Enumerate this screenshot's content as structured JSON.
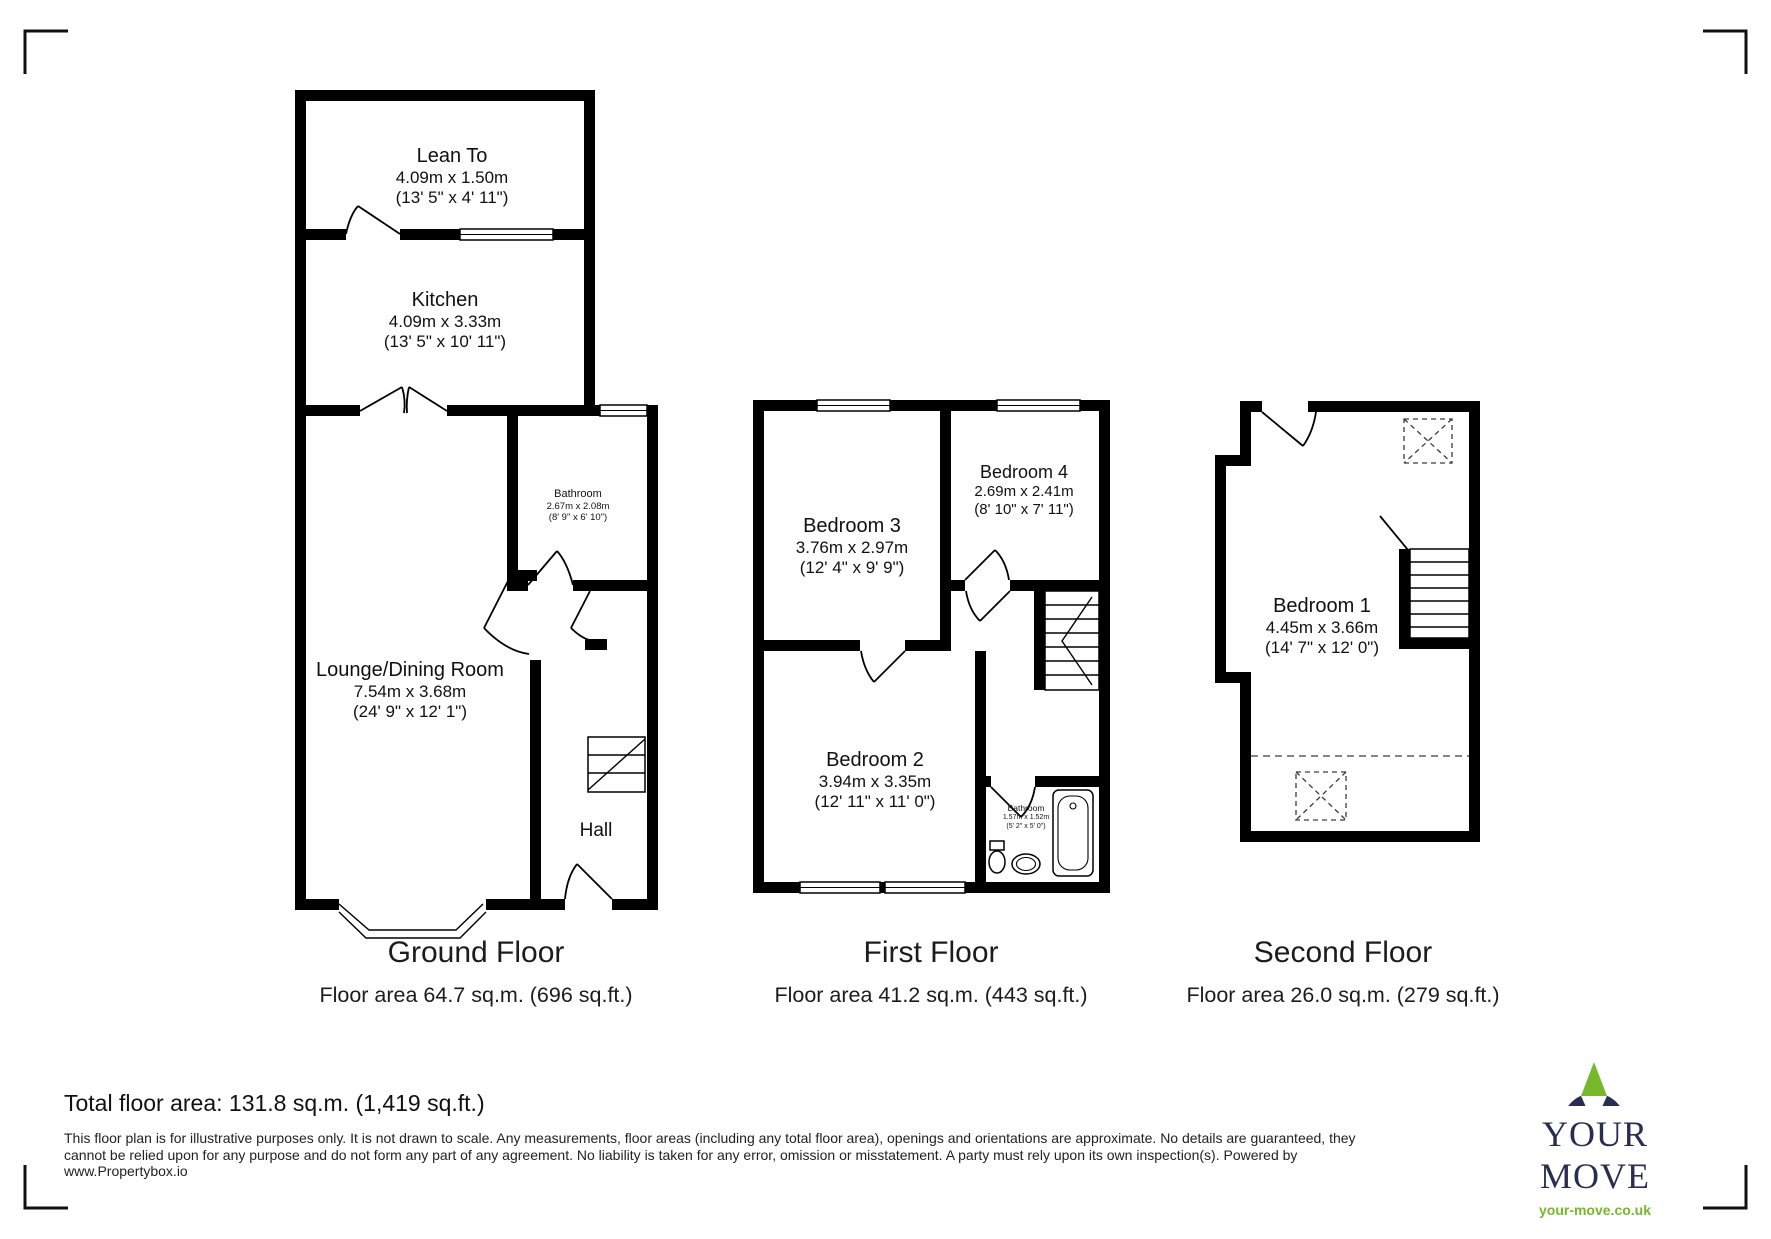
{
  "floors": [
    {
      "title": "Ground Floor",
      "area_label": "Floor area 64.7 sq.m. (696 sq.ft.)",
      "rooms": {
        "lean_to": {
          "name": "Lean To",
          "metric": "4.09m x 1.50m",
          "imperial": "(13' 5\" x 4' 11\")"
        },
        "kitchen": {
          "name": "Kitchen",
          "metric": "4.09m x 3.33m",
          "imperial": "(13' 5\" x 10' 11\")"
        },
        "bathroom": {
          "name": "Bathroom",
          "metric": "2.67m x 2.08m",
          "imperial": "(8' 9\" x 6' 10\")"
        },
        "lounge": {
          "name": "Lounge/Dining Room",
          "metric": "7.54m x 3.68m",
          "imperial": "(24' 9\" x 12' 1\")"
        },
        "hall": {
          "name": "Hall"
        }
      }
    },
    {
      "title": "First Floor",
      "area_label": "Floor area 41.2 sq.m. (443 sq.ft.)",
      "rooms": {
        "bedroom3": {
          "name": "Bedroom 3",
          "metric": "3.76m x 2.97m",
          "imperial": "(12' 4\" x 9' 9\")"
        },
        "bedroom4": {
          "name": "Bedroom 4",
          "metric": "2.69m x 2.41m",
          "imperial": "(8' 10\" x 7' 11\")"
        },
        "bedroom2": {
          "name": "Bedroom 2",
          "metric": "3.94m x 3.35m",
          "imperial": "(12' 11\" x 11' 0\")"
        },
        "bathroom": {
          "name": "Bathroom",
          "metric": "1.57m x 1.52m",
          "imperial": "(5' 2\" x 5' 0\")"
        }
      }
    },
    {
      "title": "Second Floor",
      "area_label": "Floor area 26.0 sq.m. (279 sq.ft.)",
      "rooms": {
        "bedroom1": {
          "name": "Bedroom 1",
          "metric": "4.45m x 3.66m",
          "imperial": "(14' 7\" x 12' 0\")"
        }
      }
    }
  ],
  "total_area": "Total floor area: 131.8 sq.m. (1,419 sq.ft.)",
  "disclaimer": "This floor plan is for illustrative purposes only. It is not drawn to scale. Any measurements, floor areas (including any total floor area), openings and orientations are approximate. No details are guaranteed, they cannot be relied upon for any purpose and do not form any part of any agreement. No liability is taken for any error, omission or misstatement. A party must rely upon its own inspection(s). Powered by www.Propertybox.io",
  "logo": {
    "brand": "YOUR MOVE",
    "website": "your-move.co.uk",
    "navy": "#272e52",
    "green": "#76b82a"
  }
}
